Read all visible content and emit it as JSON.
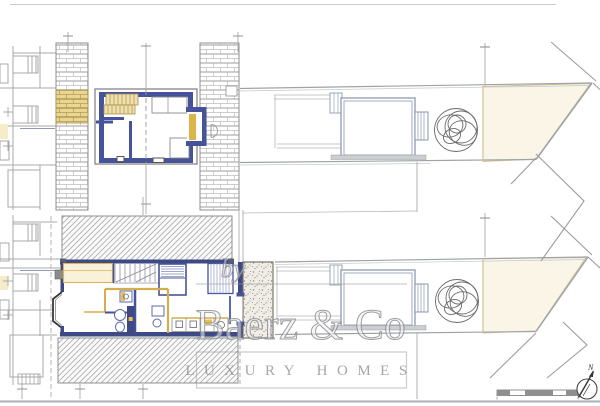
{
  "watermark": {
    "prefix": "by",
    "brand": "Baerz & Co",
    "tagline": "LUXURY HOMES"
  },
  "compass": {
    "label": "N"
  },
  "colors": {
    "wall_blue": "#46539a",
    "wall_navy": "#3d4a85",
    "accent_gold": "#ddb44a",
    "stair_tan": "#eedfac",
    "cream_zone": "#faf5e6",
    "line_gray": "#a8a8a8",
    "watermark_gray": "#97979b"
  },
  "icons": {
    "north_arrow": "north-arrow-icon",
    "tree": "tree-icon",
    "scale_bar": "scale-bar"
  }
}
